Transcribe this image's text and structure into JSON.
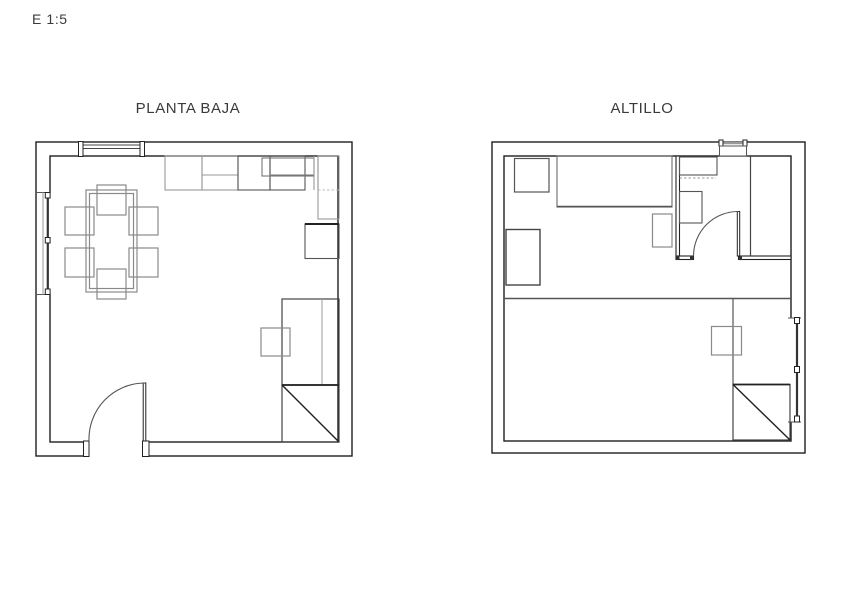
{
  "drawing": {
    "scale_label": "E 1:5",
    "plans": [
      {
        "id": "planta-baja",
        "title": "PLANTA BAJA"
      },
      {
        "id": "altillo",
        "title": "ALTILLO"
      }
    ],
    "colors": {
      "background": "#ffffff",
      "wall_line": "#1f1f1f",
      "partition_line": "#222222",
      "furniture_line": "#8a8a8a",
      "appliance_line": "#555555",
      "detail_dark": "#222222",
      "text": "#3a3a3a"
    }
  }
}
